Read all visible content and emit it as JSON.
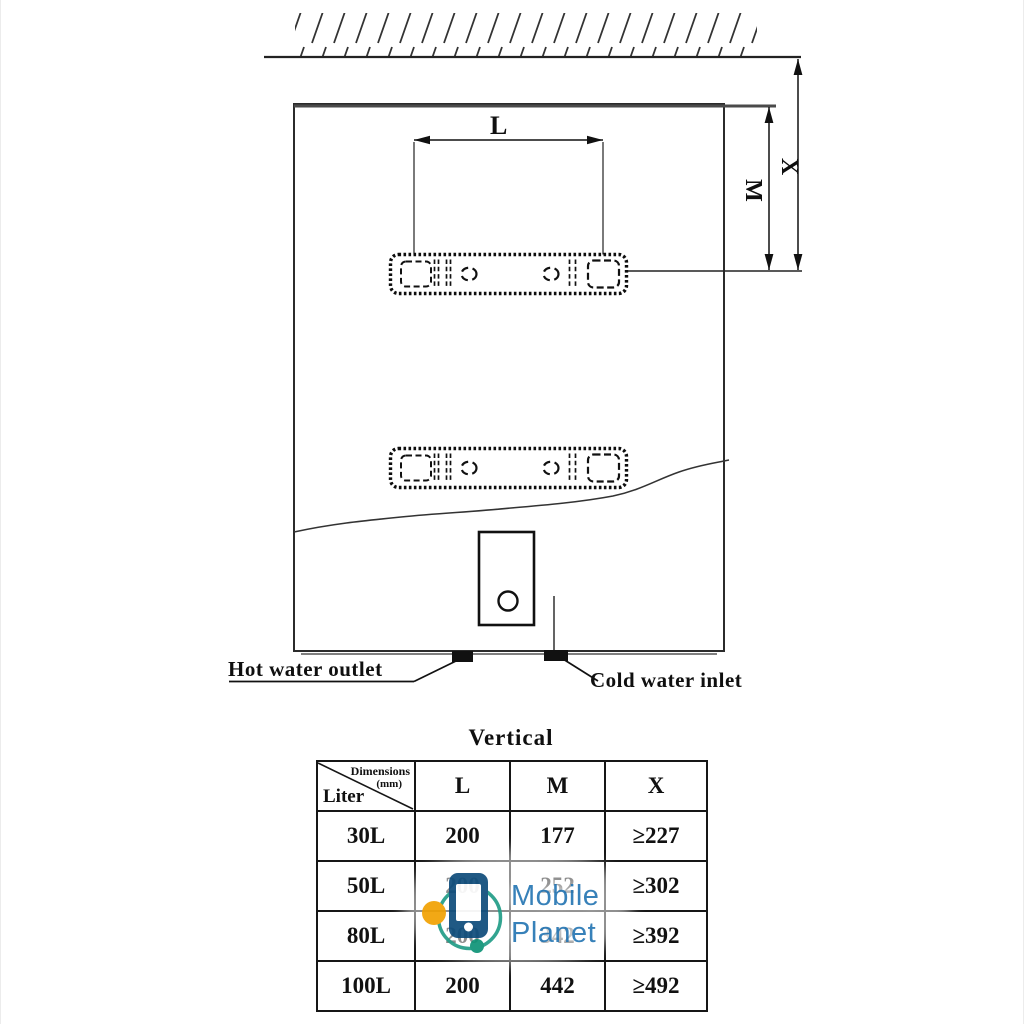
{
  "drawing": {
    "dim_labels": {
      "l": "L",
      "m": "M",
      "x": "X"
    },
    "hot_water_outlet": "Hot water outlet",
    "cold_water_inlet": "Cold water inlet"
  },
  "table": {
    "title": "Vertical",
    "corner": {
      "top": "Dimensions",
      "unit": "(mm)",
      "bottom": "Liter"
    },
    "columns": [
      "L",
      "M",
      "X"
    ],
    "rows": [
      {
        "liter": "30L",
        "L": "200",
        "M": "177",
        "X": "≥227"
      },
      {
        "liter": "50L",
        "L": "200",
        "M": "252",
        "X": "≥302"
      },
      {
        "liter": "80L",
        "L": "200",
        "M": "342",
        "X": "≥392"
      },
      {
        "liter": "100L",
        "L": "200",
        "M": "442",
        "X": "≥492"
      }
    ]
  },
  "watermark": {
    "line1": "Mobile",
    "line2": "Planet",
    "colors": {
      "phone": "#175380",
      "ring": "#2aa18c",
      "dot_orange": "#F2A50C",
      "dot_teal": "#17977C",
      "text": "#2F7CB7"
    }
  }
}
